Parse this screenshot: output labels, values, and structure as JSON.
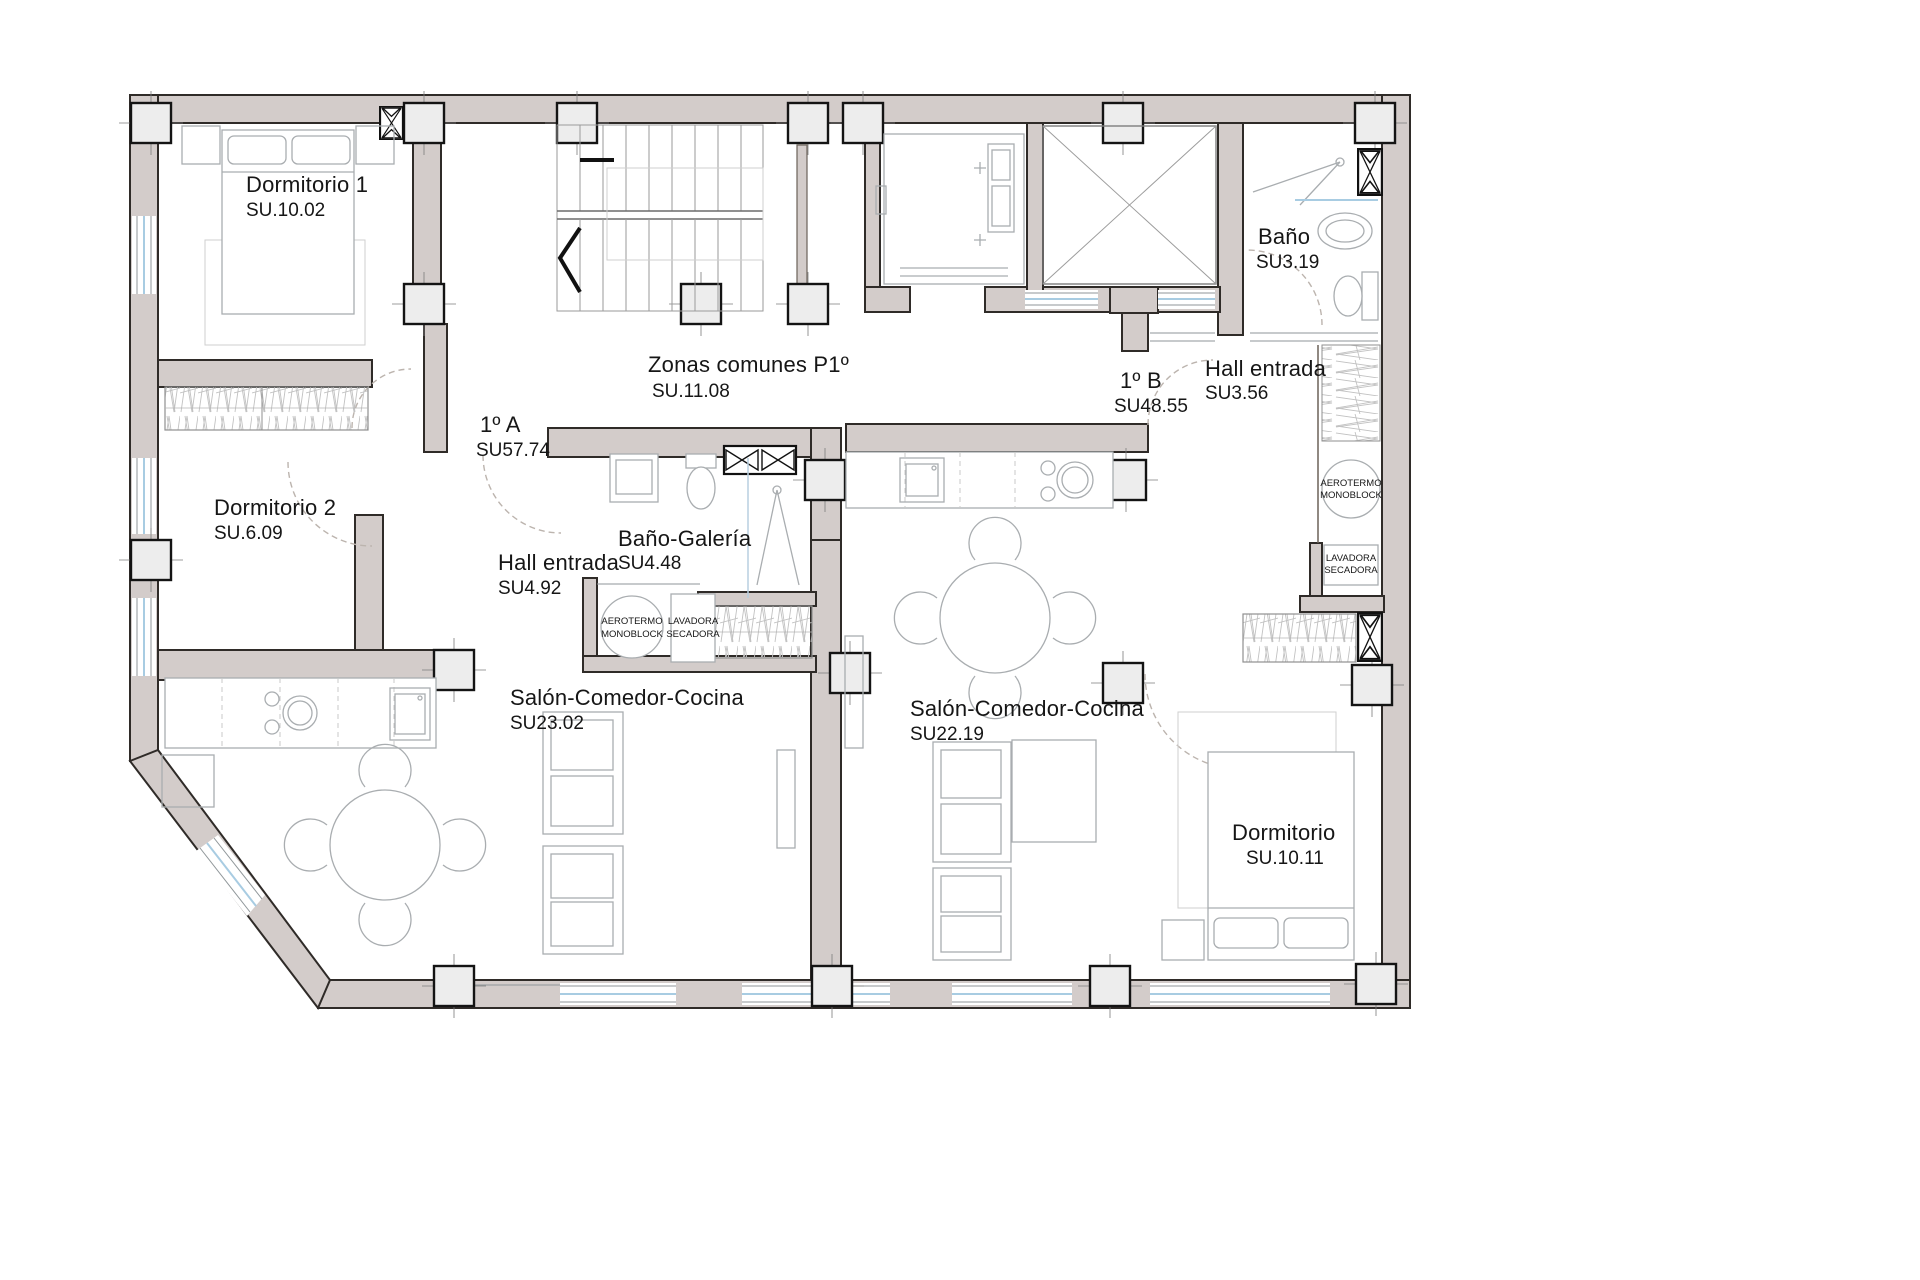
{
  "plan": {
    "type": "architectural-floor-plan",
    "wall_color": "#d3ccca",
    "pillar_color": "#ededed",
    "window_color": "#a8cce2"
  },
  "rooms": {
    "dormitorio1": {
      "name": "Dormitorio 1",
      "su": "SU.10.02"
    },
    "dormitorio2": {
      "name": "Dormitorio 2",
      "su": "SU.6.09"
    },
    "apt_a": {
      "name": "1º A",
      "su": "SU57.74"
    },
    "zonas": {
      "name": "Zonas comunes P1º",
      "su": "SU.11.08"
    },
    "bano_galeria": {
      "name": "Baño-Galería",
      "su": "SU4.48"
    },
    "hall_a": {
      "name": "Hall entrada",
      "su": "SU4.92"
    },
    "salon_a": {
      "name": "Salón-Comedor-Cocina",
      "su": "SU23.02"
    },
    "apt_b": {
      "name": "1º B",
      "su": "SU48.55"
    },
    "hall_b": {
      "name": "Hall entrada",
      "su": "SU3.56"
    },
    "bano_b": {
      "name": "Baño",
      "su": "SU3.19"
    },
    "salon_b": {
      "name": "Salón-Comedor-Cocina",
      "su": "SU22.19"
    },
    "dormitorio_b": {
      "name": "Dormitorio",
      "su": "SU.10.11"
    }
  },
  "equipment": {
    "aerotermo_line1": "AEROTERMO",
    "aerotermo_line2": "MONOBLOCK",
    "lavadora_line1": "LAVADORA",
    "lavadora_line2": "SECADORA"
  }
}
